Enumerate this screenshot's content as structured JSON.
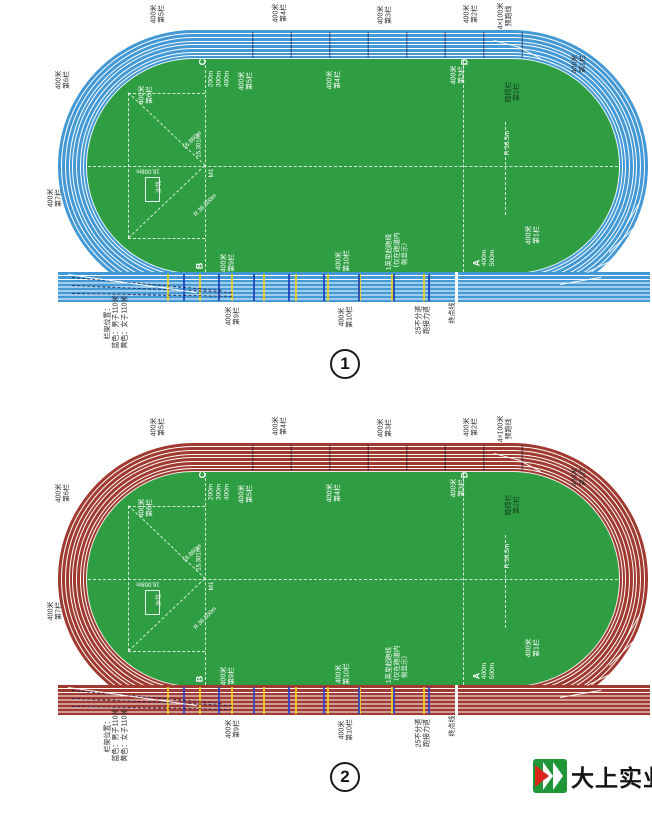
{
  "diagrams": [
    {
      "number_label": "1",
      "colors": {
        "track": "#4399d5",
        "infield": "#2f9e43",
        "lane_line": "#ffffff",
        "hurdle_men": "#1f3db8",
        "hurdle_women": "#f3d117"
      }
    },
    {
      "number_label": "2",
      "colors": {
        "track": "#a03a30",
        "infield": "#2f9e43",
        "lane_line": "#ffffff",
        "hurdle_men": "#2741c9",
        "hurdle_women": "#f3d117"
      }
    }
  ],
  "track_labels": [
    {
      "t": "400米\n第5栏",
      "x": 159,
      "y": 14
    },
    {
      "t": "400米\n第4栏",
      "x": 281,
      "y": 13
    },
    {
      "t": "400米\n第3栏",
      "x": 386,
      "y": 15
    },
    {
      "t": "400米\n第2栏",
      "x": 472,
      "y": 14
    },
    {
      "t": "4×100米\n预跑线",
      "x": 506,
      "y": 16
    },
    {
      "t": "400米\n第1栏",
      "x": 580,
      "y": 64
    },
    {
      "t": "400米\n第6栏",
      "x": 64,
      "y": 80
    },
    {
      "t": "400米\n第7栏",
      "x": 56,
      "y": 198
    },
    {
      "t": "栏架位置：\n蓝色：男子110米\n黄色：女子110米",
      "x": 117,
      "y": 322
    },
    {
      "t": "400米\n第9栏",
      "x": 234,
      "y": 316
    },
    {
      "t": "400米\n第10栏",
      "x": 347,
      "y": 317
    },
    {
      "t": "25不分道\n跑接力道",
      "x": 424,
      "y": 320
    },
    {
      "t": "终点线",
      "x": 453,
      "y": 313
    },
    {
      "t": "400米\n第6栏",
      "x": 147,
      "y": 95,
      "c": "#ffffff"
    },
    {
      "t": "400米\n第5栏",
      "x": 247,
      "y": 81,
      "c": "#ffffff"
    },
    {
      "t": "400米\n第4栏",
      "x": 335,
      "y": 80,
      "c": "#ffffff"
    },
    {
      "t": "400米\n第3栏",
      "x": 459,
      "y": 75,
      "c": "#ffffff"
    },
    {
      "t": "C",
      "x": 203,
      "y": 62,
      "c": "#ffffff",
      "s": 9,
      "b": 1
    },
    {
      "t": "200m\n300m\n400m",
      "x": 219,
      "y": 79,
      "c": "#ffffff",
      "s": 6.5
    },
    {
      "t": "D",
      "x": 465,
      "y": 62,
      "c": "#ffffff",
      "s": 9,
      "b": 1
    },
    {
      "t": "障碍栏\n第2栏",
      "x": 514,
      "y": 92,
      "c": "#0e3c1b"
    },
    {
      "t": "R 36.5m",
      "x": 508,
      "y": 143,
      "c": "#ffffff",
      "s": 6.5
    },
    {
      "t": "400米\n第1栏",
      "x": 534,
      "y": 235,
      "c": "#ffffff"
    },
    {
      "t": "A",
      "x": 477,
      "y": 263,
      "c": "#ffffff",
      "s": 9,
      "b": 1
    },
    {
      "t": "400m\n500m",
      "x": 489,
      "y": 258,
      "c": "#ffffff",
      "s": 6.5
    },
    {
      "t": "B",
      "x": 200,
      "y": 266,
      "c": "#ffffff",
      "s": 9,
      "b": 1
    },
    {
      "t": "400米\n第9栏",
      "x": 229,
      "y": 263,
      "c": "#ffffff"
    },
    {
      "t": "400米\n第10栏",
      "x": 344,
      "y": 261,
      "c": "#ffffff"
    },
    {
      "t": "1英里起跑线\n（仅在跑道内\n侧显示）",
      "x": 397,
      "y": 252,
      "c": "#ffffff",
      "s": 6.5
    },
    {
      "t": "15.301m",
      "x": 200,
      "y": 146,
      "r": -90,
      "c": "#ffffff",
      "s": 6
    },
    {
      "t": "16.008m",
      "x": 148,
      "y": 170,
      "r": 180,
      "c": "#ffffff",
      "s": 6
    },
    {
      "t": "16.860m",
      "x": 193,
      "y": 141,
      "r": -45,
      "c": "#ffffff",
      "s": 6
    },
    {
      "t": "M1",
      "x": 212,
      "y": 173,
      "c": "#ffffff",
      "s": 6.5
    },
    {
      "t": "R 36.500m",
      "x": 206,
      "y": 206,
      "r": -45,
      "c": "#ffffff",
      "s": 6
    },
    {
      "t": "沙坑",
      "x": 160,
      "y": 187,
      "c": "#ffffff",
      "s": 6
    }
  ],
  "logo": {
    "text": "大上实业",
    "icon": "ds-green-arrow-logo"
  }
}
